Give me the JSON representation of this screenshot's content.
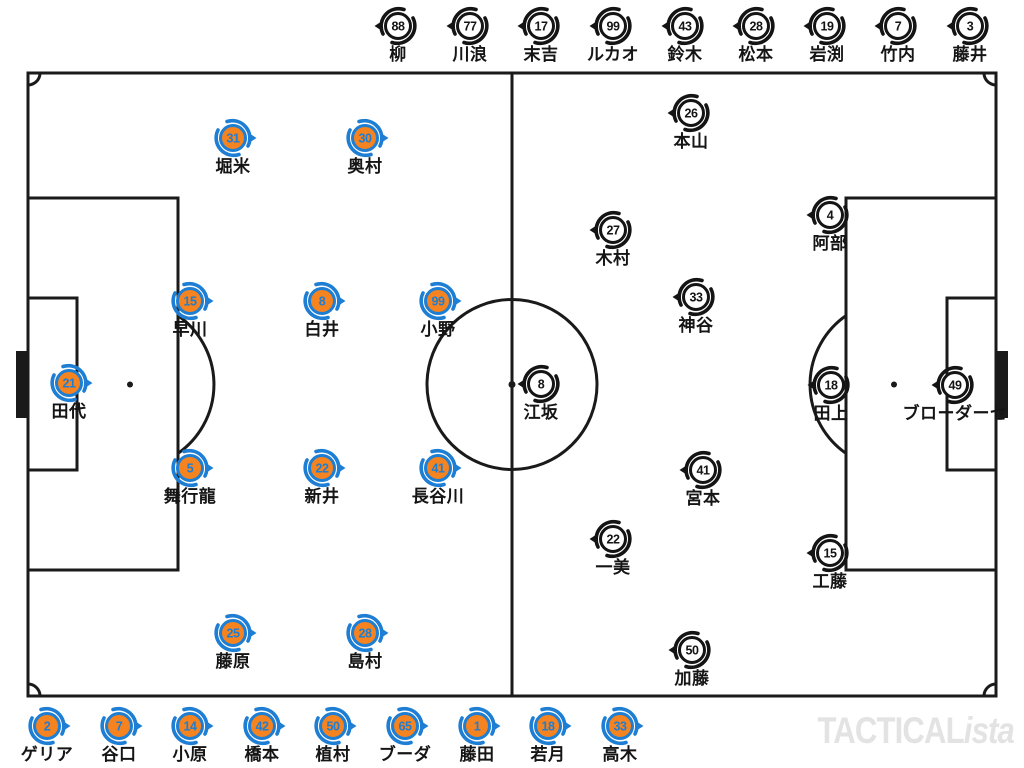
{
  "watermark": {
    "bold": "TACTICAL",
    "italic": "ista"
  },
  "colors": {
    "team_a_fill": "#f5831f",
    "team_a_accent": "#1d7ed3",
    "team_b_fill": "#ffffff",
    "team_b_accent": "#141414",
    "pitch_line": "#1a1a1a",
    "label_text": "#151515",
    "watermark": "#e3e3e3"
  },
  "teams": {
    "team_a": {
      "side": "left",
      "direction": "right"
    },
    "team_b": {
      "side": "right",
      "direction": "left"
    }
  },
  "pitch_players_team_a": [
    {
      "number": "21",
      "name": "田代",
      "x": 69,
      "y": 383
    },
    {
      "number": "31",
      "name": "堀米",
      "x": 233,
      "y": 138
    },
    {
      "number": "30",
      "name": "奥村",
      "x": 365,
      "y": 138
    },
    {
      "number": "15",
      "name": "早川",
      "x": 190,
      "y": 301
    },
    {
      "number": "8",
      "name": "白井",
      "x": 322,
      "y": 301
    },
    {
      "number": "99",
      "name": "小野",
      "x": 438,
      "y": 301
    },
    {
      "number": "5",
      "name": "舞行龍",
      "x": 190,
      "y": 468
    },
    {
      "number": "22",
      "name": "新井",
      "x": 322,
      "y": 468
    },
    {
      "number": "41",
      "name": "長谷川",
      "x": 438,
      "y": 468
    },
    {
      "number": "25",
      "name": "藤原",
      "x": 233,
      "y": 633
    },
    {
      "number": "28",
      "name": "島村",
      "x": 365,
      "y": 633
    }
  ],
  "pitch_players_team_b": [
    {
      "number": "26",
      "name": "本山",
      "x": 691,
      "y": 113
    },
    {
      "number": "27",
      "name": "木村",
      "x": 613,
      "y": 230
    },
    {
      "number": "33",
      "name": "神谷",
      "x": 696,
      "y": 297
    },
    {
      "number": "8",
      "name": "江坂",
      "x": 541,
      "y": 384
    },
    {
      "number": "4",
      "name": "阿部",
      "x": 830,
      "y": 215
    },
    {
      "number": "18",
      "name": "田上",
      "x": 831,
      "y": 385
    },
    {
      "number": "49",
      "name": "ブローダーセ",
      "x": 955,
      "y": 385
    },
    {
      "number": "41",
      "name": "宮本",
      "x": 703,
      "y": 470
    },
    {
      "number": "22",
      "name": "一美",
      "x": 613,
      "y": 539
    },
    {
      "number": "15",
      "name": "工藤",
      "x": 830,
      "y": 553
    },
    {
      "number": "50",
      "name": "加藤",
      "x": 692,
      "y": 650
    }
  ],
  "bench_top_team_b": [
    {
      "number": "88",
      "name": "柳",
      "x": 398,
      "y": 26
    },
    {
      "number": "77",
      "name": "川浪",
      "x": 470,
      "y": 26
    },
    {
      "number": "17",
      "name": "末吉",
      "x": 541,
      "y": 26
    },
    {
      "number": "99",
      "name": "ルカオ",
      "x": 613,
      "y": 26
    },
    {
      "number": "43",
      "name": "鈴木",
      "x": 685,
      "y": 26
    },
    {
      "number": "28",
      "name": "松本",
      "x": 756,
      "y": 26
    },
    {
      "number": "19",
      "name": "岩渕",
      "x": 827,
      "y": 26
    },
    {
      "number": "7",
      "name": "竹内",
      "x": 898,
      "y": 26
    },
    {
      "number": "3",
      "name": "藤井",
      "x": 970,
      "y": 26
    }
  ],
  "bench_bottom_team_a": [
    {
      "number": "2",
      "name": "ゲリア",
      "x": 47,
      "y": 726
    },
    {
      "number": "7",
      "name": "谷口",
      "x": 119,
      "y": 726
    },
    {
      "number": "14",
      "name": "小原",
      "x": 190,
      "y": 726
    },
    {
      "number": "42",
      "name": "橋本",
      "x": 262,
      "y": 726
    },
    {
      "number": "50",
      "name": "植村",
      "x": 333,
      "y": 726
    },
    {
      "number": "65",
      "name": "ブーダ",
      "x": 405,
      "y": 726
    },
    {
      "number": "1",
      "name": "藤田",
      "x": 477,
      "y": 726
    },
    {
      "number": "18",
      "name": "若月",
      "x": 548,
      "y": 726
    },
    {
      "number": "33",
      "name": "高木",
      "x": 620,
      "y": 726
    }
  ]
}
